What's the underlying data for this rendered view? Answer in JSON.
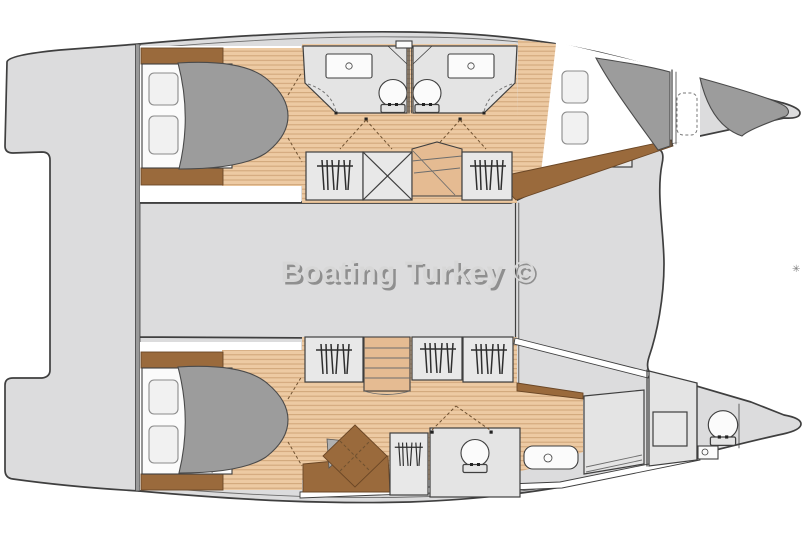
{
  "watermark": {
    "text": "Boating Turkey ©"
  },
  "corner_mark": "✳",
  "colors": {
    "background": "#ffffff",
    "hull_fill": "#dcdcdd",
    "outline": "#3f3f3f",
    "wood": "#edcaa3",
    "wood_stripe": "#cfa478",
    "wood_dark": "#e5bb92",
    "trim_brown": "#9a6a3c",
    "trim_brown_dark": "#6b4726",
    "duvet_gray": "#9c9c9c",
    "room_gray": "#e4e4e4",
    "cabinet_gray": "#e8e8e8",
    "fixture_white": "#fbfbfb",
    "pillow_gray": "#f1f1f1",
    "watermark_gray": "#d7d7d7",
    "watermark_shadow": "#8f8f8f",
    "dash_brown": "#6f5130"
  },
  "legend": {
    "glyphs": [
      "double-berth",
      "pillow",
      "toilet",
      "sink-counter",
      "vanity-sink",
      "wardrobe-hanging-clothes",
      "storage-x-box",
      "companionway-stairs",
      "shower-compartment",
      "mast-post",
      "bow-locker-berth"
    ]
  }
}
